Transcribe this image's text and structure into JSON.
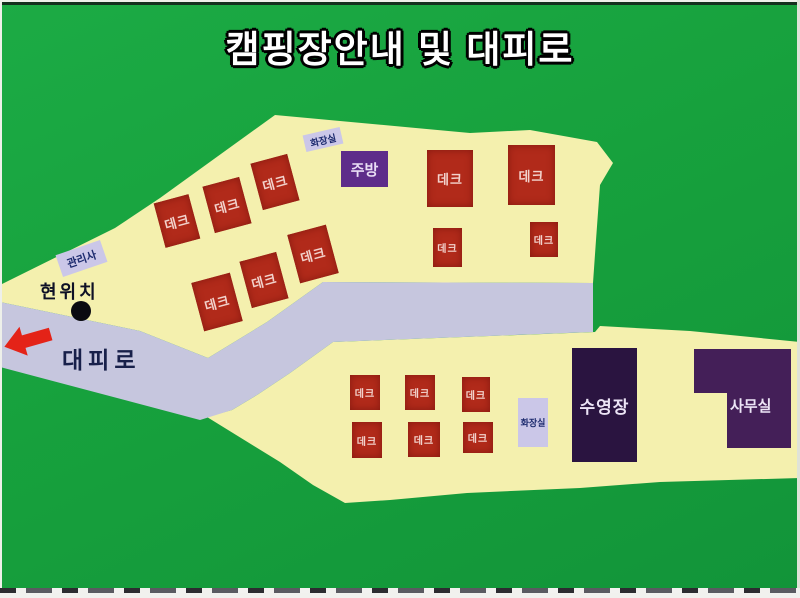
{
  "title": "캠핑장안내 및 대피로",
  "colors": {
    "green": "#17a13d",
    "green_hi": "#1cab45",
    "green_lo": "#129439",
    "yellow": "#f4f0ae",
    "road": "#c6c6de",
    "deck_red": "#b12a1a",
    "kitchen": "#5e2c8a",
    "pool": "#2a1440",
    "office": "#441f58",
    "label_bg": "#cbc7e8",
    "label_text": "#1c2a6e",
    "arrow": "#e42318"
  },
  "map": {
    "deck_label": "데크",
    "decks": [
      {
        "x": 159,
        "y": 198,
        "w": 36,
        "h": 46,
        "rot": -15
      },
      {
        "x": 208,
        "y": 181,
        "w": 38,
        "h": 48,
        "rot": -15
      },
      {
        "x": 256,
        "y": 158,
        "w": 38,
        "h": 48,
        "rot": -15
      },
      {
        "x": 197,
        "y": 277,
        "w": 40,
        "h": 50,
        "rot": -15
      },
      {
        "x": 245,
        "y": 256,
        "w": 38,
        "h": 48,
        "rot": -15
      },
      {
        "x": 293,
        "y": 229,
        "w": 40,
        "h": 50,
        "rot": -15
      },
      {
        "x": 427,
        "y": 150,
        "w": 46,
        "h": 57,
        "rot": 0
      },
      {
        "x": 508,
        "y": 145,
        "w": 47,
        "h": 60,
        "rot": 0
      },
      {
        "x": 433,
        "y": 228,
        "w": 29,
        "h": 39,
        "rot": 0
      },
      {
        "x": 530,
        "y": 222,
        "w": 28,
        "h": 35,
        "rot": 0
      },
      {
        "x": 350,
        "y": 375,
        "w": 30,
        "h": 35,
        "rot": 0
      },
      {
        "x": 405,
        "y": 375,
        "w": 30,
        "h": 35,
        "rot": 0
      },
      {
        "x": 462,
        "y": 377,
        "w": 28,
        "h": 35,
        "rot": 0
      },
      {
        "x": 352,
        "y": 422,
        "w": 30,
        "h": 36,
        "rot": 0
      },
      {
        "x": 408,
        "y": 422,
        "w": 32,
        "h": 35,
        "rot": 0
      },
      {
        "x": 463,
        "y": 422,
        "w": 30,
        "h": 31,
        "rot": 0
      }
    ],
    "buildings": {
      "kitchen": {
        "label": "주방"
      },
      "pool": {
        "label": "수영장"
      },
      "office": {
        "label": "사무실"
      },
      "toilet_upper": {
        "label": "화장실"
      },
      "toilet_lower": {
        "label": "화장실"
      },
      "manager_office": {
        "label": "관리사"
      }
    },
    "annotations": {
      "current_location": "현위치",
      "evacuation_route": "대피로"
    }
  }
}
